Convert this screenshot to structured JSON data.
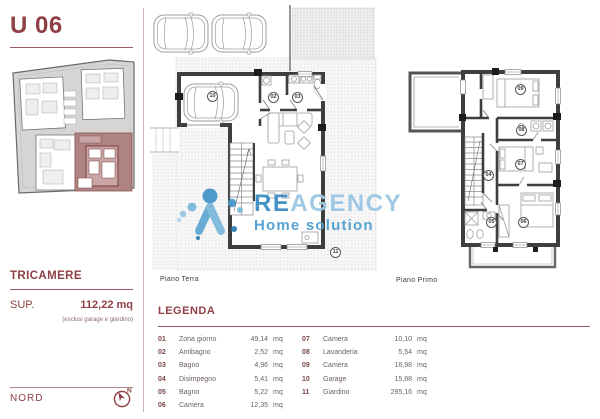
{
  "colors": {
    "accent_maroon": "#8e4045",
    "wall_dark": "#3e3e3e",
    "logo_blue_dark": "#3c8dc1",
    "logo_blue_light": "#9ac7e3",
    "logo_blue_mid": "#4f9ed0",
    "site_plan_highlight": "#b08383"
  },
  "sidebar": {
    "unit_title": "U 06",
    "type_label": "TRICAMERE",
    "sup_label": "SUP.",
    "sup_value": "112,22 mq",
    "sup_note": "(esclusi garage e giardino)",
    "north_label": "NORD"
  },
  "plans": {
    "ground": {
      "caption": "Piano Terra",
      "labels": [
        "10",
        "02",
        "03",
        "11"
      ]
    },
    "first": {
      "caption": "Piano Primo",
      "labels": [
        "09",
        "08",
        "04",
        "07",
        "05",
        "06"
      ]
    }
  },
  "watermark": {
    "brand_primary": "RE",
    "brand_secondary": "AGENCY",
    "tagline": "Home solution"
  },
  "legend": {
    "title": "LEGENDA",
    "items": [
      {
        "num": "01",
        "name": "Zona giorno",
        "value": "49,14",
        "unit": "mq"
      },
      {
        "num": "02",
        "name": "Antibagno",
        "value": "2,52",
        "unit": "mq"
      },
      {
        "num": "03",
        "name": "Bagno",
        "value": "4,96",
        "unit": "mq"
      },
      {
        "num": "04",
        "name": "Disimpegno",
        "value": "5,41",
        "unit": "mq"
      },
      {
        "num": "05",
        "name": "Bagno",
        "value": "5,22",
        "unit": "mq"
      },
      {
        "num": "06",
        "name": "Camera",
        "value": "12,35",
        "unit": "mq"
      },
      {
        "num": "07",
        "name": "Camera",
        "value": "10,10",
        "unit": "mq"
      },
      {
        "num": "08",
        "name": "Lavanderia",
        "value": "5,54",
        "unit": "mq"
      },
      {
        "num": "09",
        "name": "Camera",
        "value": "16,98",
        "unit": "mq"
      },
      {
        "num": "10",
        "name": "Garage",
        "value": "15,88",
        "unit": "mq"
      },
      {
        "num": "11",
        "name": "Giardino",
        "value": "295,16",
        "unit": "mq"
      }
    ]
  }
}
